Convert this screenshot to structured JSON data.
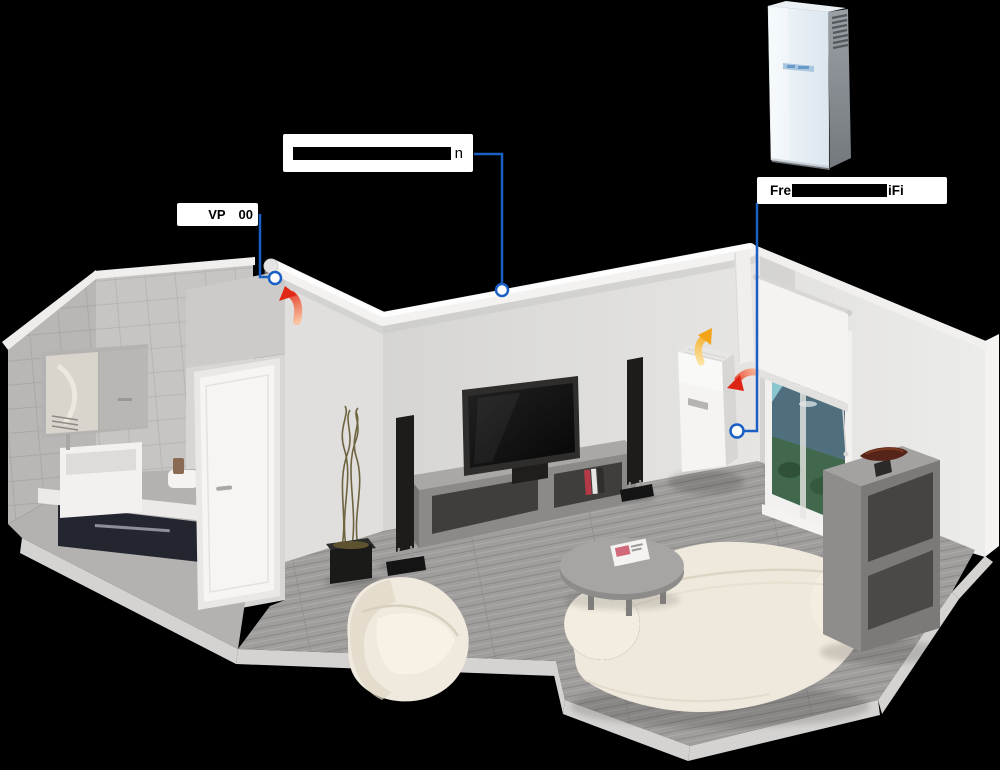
{
  "background_color": "#000000",
  "callout_labels": {
    "duct_vent": {
      "text_prefix": "VP",
      "text_suffix": "00",
      "middle_obscured": true
    },
    "ceiling_duct": {
      "text_suffix": "n",
      "text_redacted": true
    },
    "ventilation_unit": {
      "text_prefix": "Fre",
      "text_suffix": "iFi",
      "middle_redacted": true
    }
  },
  "colors": {
    "callout_line": "#1a5fc4",
    "marker_fill": "#ffffff",
    "label_background": "#ffffff",
    "label_text": "#000000",
    "redaction_bar": "#000000",
    "arrow_red": "#e02817",
    "arrow_yellow": "#f2a318",
    "wall_light": "#e6e5e3",
    "floor_gray": "#9d9b99",
    "sofa_cream": "#efe8dc",
    "product_front": "#eef4f8",
    "product_side": "#84898e",
    "window_sky": "#7fc4cc"
  },
  "scene_objects": [
    "ceiling-duct",
    "duct-exhaust-vent",
    "heat-recovery-wall-unit",
    "airflow-arrow-exhaust",
    "airflow-arrow-supply",
    "airflow-arrow-intake",
    "product-outdoor-view",
    "window-with-roller-blind",
    "flat-screen-tv",
    "tv-stand",
    "floor-speakers",
    "decorative-branches-plant",
    "round-coffee-table",
    "cream-armchair",
    "cream-sofa",
    "open-bookshelf",
    "bathroom-vanity-sink",
    "mirror-cabinet",
    "interior-door"
  ]
}
